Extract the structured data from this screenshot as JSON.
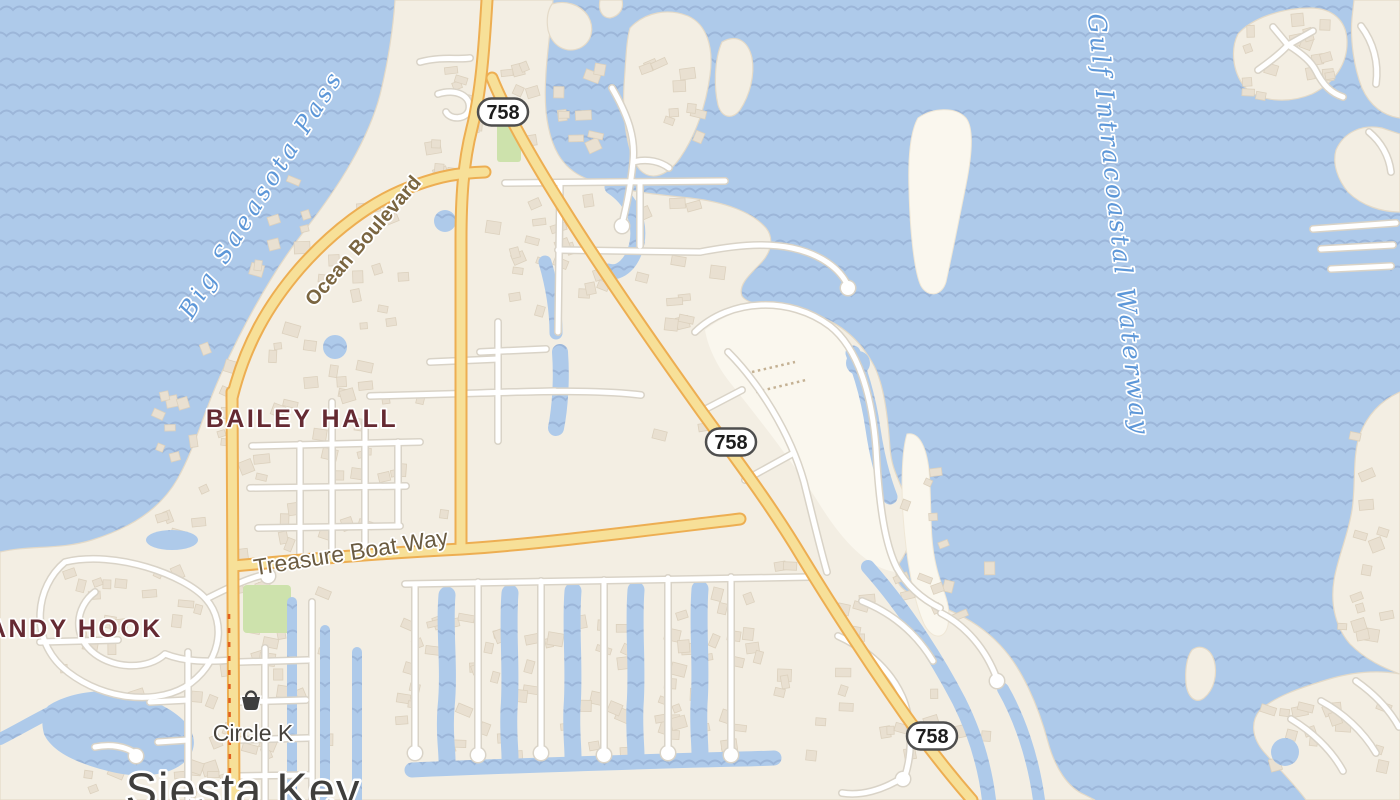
{
  "colors": {
    "water": "#AECAEA",
    "wave": "#9CB6D9",
    "land": "#F3EEE3",
    "land-pale": "#FAF7EE",
    "coast": "#E4DAC8",
    "coast-pale": "#EFE7D6",
    "building": "#E9E0D1",
    "building-stroke": "#DCD1BE",
    "road": "#FFFFFF",
    "road-casing": "#D9D3C7",
    "hwy": "#F7E098",
    "hwy-casing": "#EDAE52",
    "park": "#CDE2AC",
    "construction": "#E0601F",
    "pier": "#C4B193",
    "shield-border": "#4E4E4E",
    "shield-text": "#1D1D1D",
    "label-water": "#5D97D8",
    "label-area": "#652A32",
    "label-road": "#6A5B41",
    "label-road2": "#7A6540",
    "label-city": "#3F3E3C",
    "label-poi": "#45413B",
    "poi-icon": "#3E3E3E"
  },
  "labels": {
    "water_features": [
      {
        "text": "Big Saeasota Pass"
      },
      {
        "text": "Gulf Intracoastal Waterway"
      }
    ],
    "neighborhoods": [
      {
        "text": "BAILEY HALL"
      },
      {
        "text": "ANDY HOOK"
      }
    ],
    "streets": [
      {
        "text": "Ocean Boulevard"
      },
      {
        "text": "Treasure Boat Way"
      }
    ],
    "city": {
      "text": "Siesta Key"
    },
    "poi": {
      "text": "Circle K",
      "icon": "shopping-basket-icon"
    }
  },
  "route_shields": [
    {
      "route": "758"
    },
    {
      "route": "758"
    },
    {
      "route": "758"
    }
  ]
}
